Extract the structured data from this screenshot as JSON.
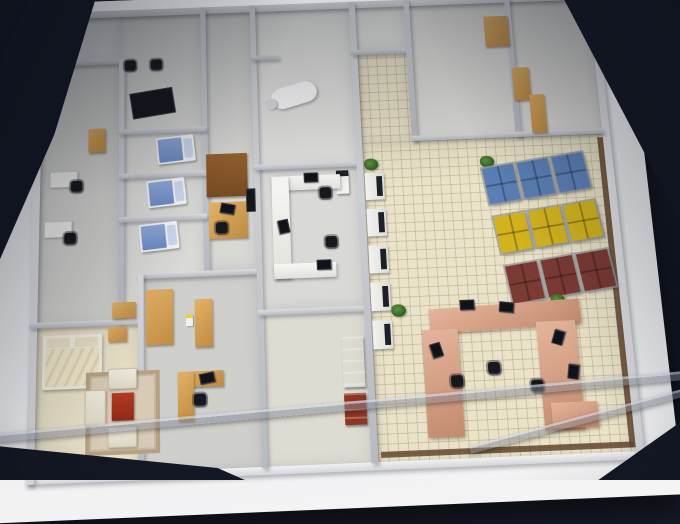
{
  "meta": {
    "scene_type": "photograph",
    "subject": "architectural scale model of a clinic floor plan on a white platform"
  },
  "caption": {
    "text": "平面图（三层）"
  },
  "palette": {
    "background": "#161a26",
    "platform": "#e9eaec",
    "hall_tile_floor": "#eae3c9",
    "room_floor": "#d9d9d6",
    "wall": "#c0c3c9",
    "wood": "#d7a55e",
    "patient_bed_blue": "#7d9bd0",
    "bench_blue": "#5b7fb5",
    "bench_yellow": "#d2b31e",
    "bench_dark_red": "#7c3a34",
    "reception_counter_pink": "#d79f87",
    "plant_green": "#3f7a2e",
    "acrylic_gray": "#9aa0ae"
  },
  "inventory": {
    "patient_beds": 3,
    "double_bed": 1,
    "waiting_bench_rows": [
      {
        "color_name": "blue"
      },
      {
        "color_name": "yellow"
      },
      {
        "color_name": "dark-red"
      }
    ],
    "self_service_kiosks": 5,
    "plants": 4,
    "reception_counter_shape": "U",
    "computer_monitors": 10,
    "office_chairs": 9
  }
}
